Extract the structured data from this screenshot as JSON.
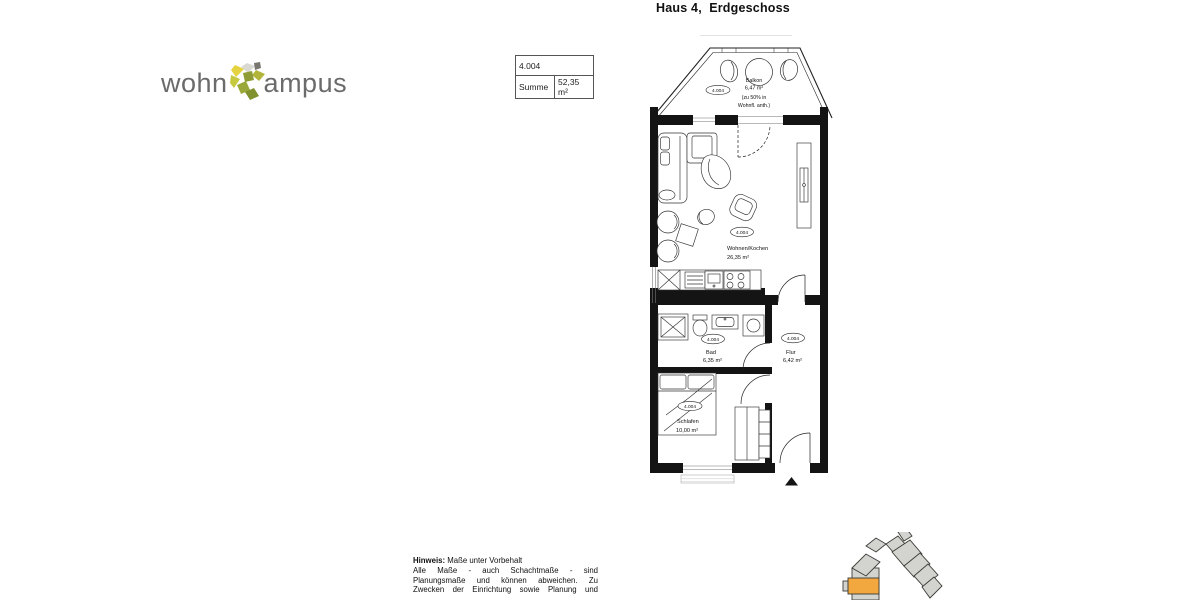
{
  "page": {
    "title": "Haus 4,  Erdgeschoss"
  },
  "logo": {
    "text_left": "wohn",
    "text_right": "ampus"
  },
  "info_table": {
    "unit": "4.004",
    "row_label": "Summe",
    "row_value": "52,35 m²"
  },
  "floorplan": {
    "balkon": {
      "tag": "4.004",
      "name": "Balkon",
      "area": "6,47 m²",
      "note_line1": "(zu 50% in",
      "note_line2": "Wohnfl. anth.)"
    },
    "wohnen": {
      "tag": "4.004",
      "name": "Wohnen/Kochen",
      "area": "26,35 m²"
    },
    "bad": {
      "tag": "4.004",
      "name": "Bad",
      "area": "6,35 m²"
    },
    "flur": {
      "tag": "4.004",
      "name": "Flur",
      "area": "6,42 m²"
    },
    "schlafen": {
      "tag": "4.004",
      "name": "Schlafen",
      "area": "10,00 m²"
    }
  },
  "hinweis": {
    "label": "Hinweis:",
    "intro": "Maße unter Vorbehalt",
    "lines": [
      "Alle Maße - auch Schachtmaße - sind",
      "Planungsmaße und können abweichen. Zu",
      "Zwecken der Einrichtung sowie Planung und"
    ]
  },
  "colors": {
    "site_building": "#D3D3CF",
    "site_highlight": "#F2A73F"
  }
}
